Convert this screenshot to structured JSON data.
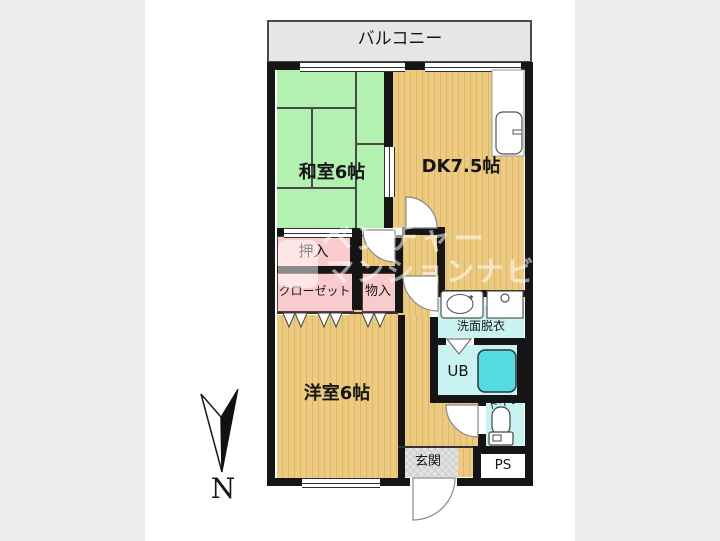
{
  "plan": {
    "labels": {
      "balcony": "バルコニー",
      "japanese_room": "和室6帖",
      "dining_kitchen": "DK7.5帖",
      "oshiire": "押入",
      "closet": "クローゼット",
      "storage": "物入",
      "western_room": "洋室6帖",
      "washroom": "洗面脱衣",
      "unit_bath": "UB",
      "toilet": "トイレ",
      "entrance": "玄関",
      "pipe_space": "PS"
    },
    "compass": {
      "label": "N"
    },
    "watermark": {
      "line1": "ベンチャー",
      "line2": "マンションナビ",
      "line3": "NAVI"
    },
    "colors": {
      "page_bg": "#ececec",
      "wall": "#151515",
      "tatami_green": "#b3f1b1",
      "wood_tan": "#eccb81",
      "wood_stripe": "#ddb668",
      "closet_pink": "#f8cccc",
      "wet_area_cyan": "#c9f3f0",
      "bathtub_cyan": "#54dce4",
      "balcony_gray": "#e6e6e6",
      "entrance_gray": "#e3e3e3"
    }
  }
}
